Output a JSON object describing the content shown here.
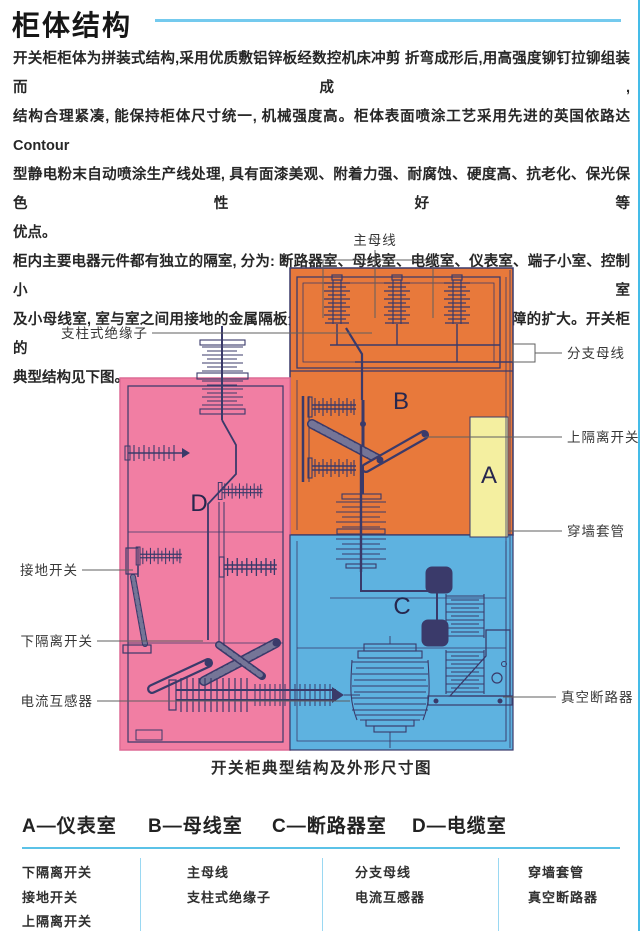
{
  "header": {
    "title": "柜体结构"
  },
  "intro": {
    "p1_lines": [
      "开关柜柜体为拼装式结构,采用优质敷铝锌板经数控机床冲剪 折弯成形后,用高强度铆钉拉铆组装而成,",
      "结构合理紧凑, 能保持柜体尺寸统一, 机械强度高。柜体表面喷涂工艺采用先进的英国依路达 Contour",
      "型静电粉末自动喷涂生产线处理, 具有面漆美观、附着力强、耐腐蚀、硬度高、抗老化、保光保色性好等",
      "优点。"
    ],
    "p2_lines": [
      "柜内主要电器元件都有独立的隔室, 分为: 断路器室、母线室、电缆室、仪表室、端子小室、控制小室",
      "及小母线室, 室与室之间用接地的金属隔板分隔, 互不干扰, 可有效防止室内故障的扩大。开关柜的",
      "典型结构见下图。"
    ]
  },
  "diagram": {
    "caption": "开关柜典型结构及外形尺寸图",
    "region_letters": {
      "a": "A",
      "b": "B",
      "c": "C",
      "d": "D"
    },
    "labels": {
      "main_busbar": "主母线",
      "post_insulator": "支柱式绝缘子",
      "branch_busbar": "分支母线",
      "upper_disconnector": "上隔离开关",
      "wall_bushing": "穿墙套管",
      "earthing_switch": "接地开关",
      "lower_disconnector": "下隔离开关",
      "current_transformer": "电流互感器",
      "vacuum_breaker": "真空断路器"
    },
    "colors": {
      "orange": "#E8793B",
      "pink": "#F17EA3",
      "blue": "#5EB2E0",
      "yellow": "#F4EFA0",
      "line": "#3A3A6A",
      "leader": "#5F5F5F"
    }
  },
  "legend": {
    "accent_color": "#5BC2E7",
    "columns": [
      {
        "header": "A—仪表室",
        "items": [
          "下隔离开关",
          "接地开关",
          "上隔离开关"
        ]
      },
      {
        "header": "B—母线室",
        "items": [
          "主母线",
          "支柱式绝缘子"
        ]
      },
      {
        "header": "C—断路器室",
        "items": [
          "分支母线",
          "电流互感器"
        ]
      },
      {
        "header": "D—电缆室",
        "items": [
          "穿墙套管",
          "真空断路器"
        ]
      }
    ]
  }
}
